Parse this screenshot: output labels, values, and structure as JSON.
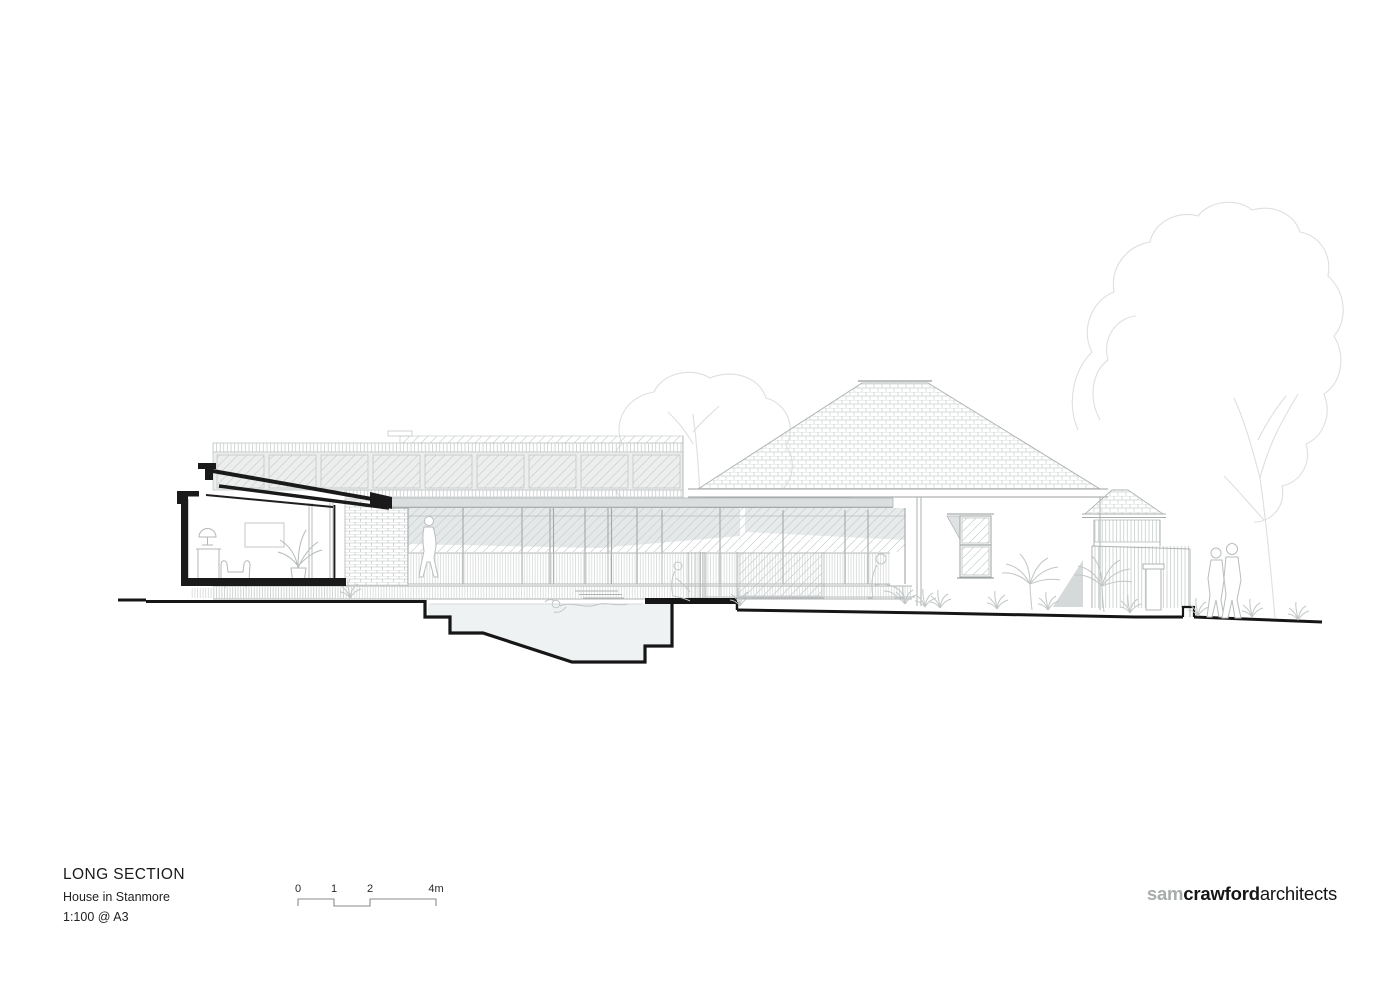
{
  "title_block": {
    "title": "LONG SECTION",
    "project": "House in Stanmore",
    "scale_note": "1:100 @ A3"
  },
  "scale_bar": {
    "labels": [
      "0",
      "1",
      "2",
      "4m"
    ]
  },
  "logo": {
    "gray": "sam",
    "bold": "crawford",
    "light": "architects"
  },
  "drawing": {
    "type": "architectural-long-section",
    "elements": [
      "sectioned-front-room",
      "clerestory-windows",
      "glazed-living-wall",
      "brick-pier",
      "timber-deck",
      "pool-balustrade",
      "swimming-pool-section",
      "existing-house-elevation",
      "hipped-tile-roof",
      "veranda-window",
      "double-hung-window",
      "rear-outbuilding",
      "batten-fence",
      "palm-trees",
      "background-trees",
      "people-figures",
      "ground-line"
    ],
    "colors": {
      "cut_poche": "#1a1a1a",
      "pool_water": "#eef2f2",
      "light_linework": "#c4c8c8",
      "roof_band": "#dbdede"
    }
  }
}
